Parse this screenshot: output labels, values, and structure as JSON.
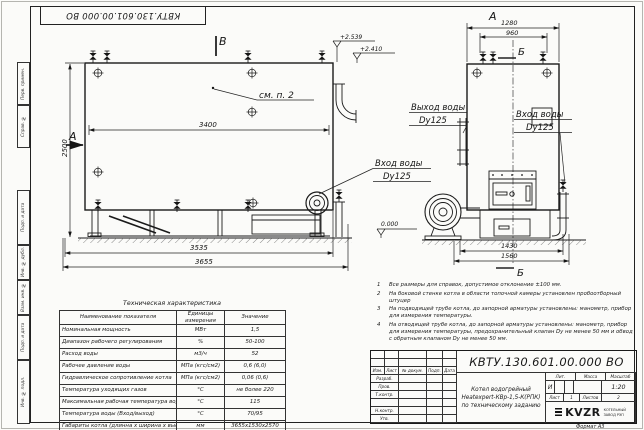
{
  "stamp": {
    "top_inverted_number": "КВТУ.130.601.00.000  ВО",
    "side_labels": [
      "Перв. примен.",
      "Справ. №",
      "Подп. и дата",
      "Инв. № дубл.",
      "Взам. инв. №",
      "Подп. и дата",
      "Инв. № подл."
    ]
  },
  "left_view": {
    "section_a": "А",
    "section_b": "В",
    "elevation_top": "+2.539",
    "elevation_mid": "+2.410",
    "elevation_zero": "0.000",
    "note_ref": "см. п. 2",
    "dim_width_inner": "3400",
    "dim_height": "2500",
    "dim_base": "3535",
    "dim_overall": "3655",
    "inlet_line1": "Вход воды",
    "inlet_line2": "Dy125"
  },
  "right_view": {
    "section_a": "А",
    "section_b_top": "Б",
    "section_b_bottom": "Б",
    "dim_top_outer": "1280",
    "dim_top_inner": "960",
    "dim_bottom_inner": "1430",
    "dim_bottom_outer": "1560",
    "outlet_line1": "Выход воды",
    "outlet_line2": "Dy125",
    "inlet_line1": "Вход воды",
    "inlet_line2": "Dy125"
  },
  "spec_table": {
    "title": "Техническая характеристика",
    "headers": [
      "Наименование показателя",
      "Единицы измерения",
      "Значение"
    ],
    "rows": [
      [
        "Номинальная мощность",
        "МВт",
        "1,5"
      ],
      [
        "Диапазон рабочего регулирования",
        "%",
        "50-100"
      ],
      [
        "Расход воды",
        "м3/ч",
        "52"
      ],
      [
        "Рабочее давление воды",
        "МПа (кгс/см2)",
        "0,6 (6,0)"
      ],
      [
        "Гидравлическое сопротивление котла",
        "МПа (кгс/см2)",
        "0,06 (0,6)"
      ],
      [
        "Температура уходящих газов",
        "°С",
        "не более 220"
      ],
      [
        "Максимальная рабочая температура воды",
        "°С",
        "115"
      ],
      [
        "Температура воды (Вход/выход)",
        "°С",
        "70/95"
      ],
      [
        "Габариты котла (длинна х ширина х высота)",
        "мм",
        "3655х1530х2570"
      ]
    ]
  },
  "notes": {
    "items": [
      {
        "num": "1",
        "text": "Все размеры для справок, допустимое отклонение ±100 мм."
      },
      {
        "num": "2",
        "text": "На боковой стенке котла в области топочной камеры установлен пробоотборный штуцер"
      },
      {
        "num": "3",
        "text": "На подводящей трубе котла, до запорной арматуры установлены: манометр, прибор для измерения температуры."
      },
      {
        "num": "4",
        "text": "На отводящей трубе котла, до запорной арматуры установлены: манометр, прибор для измерения температуры, предохранительный клапан Dу не менее 50 мм и обвод с обратным клапаном Dу не менее 50 мм."
      }
    ]
  },
  "title_block": {
    "doc_number": "КВТУ.130.601.00.000  ВО",
    "description_line1": "Котел водогрейный",
    "description_line2": "Heatexpert-КВр-1,5-К(РПК)",
    "description_line3": "по техническому заданию",
    "header_cells": [
      "Изм.",
      "Лист",
      "№ докум.",
      "Подп.",
      "Дата"
    ],
    "row_labels": [
      "Разраб.",
      "Пров.",
      "Т.контр.",
      "",
      "Н.контр.",
      "Утв."
    ],
    "lit_header": "Лит.",
    "mass_header": "Масса",
    "scale_header": "Масштаб",
    "lit_value": "И",
    "scale_value": "1:20",
    "sheet_label": "Лист",
    "sheet_value": "1",
    "sheets_label": "Листов",
    "sheets_value": "2",
    "company_logo": "KVZR",
    "company_name_1": "КОТЕЛЬНЫЙ",
    "company_name_2": "ЗАВОД РЭП",
    "format_label": "Формат",
    "format_value": "А3"
  }
}
